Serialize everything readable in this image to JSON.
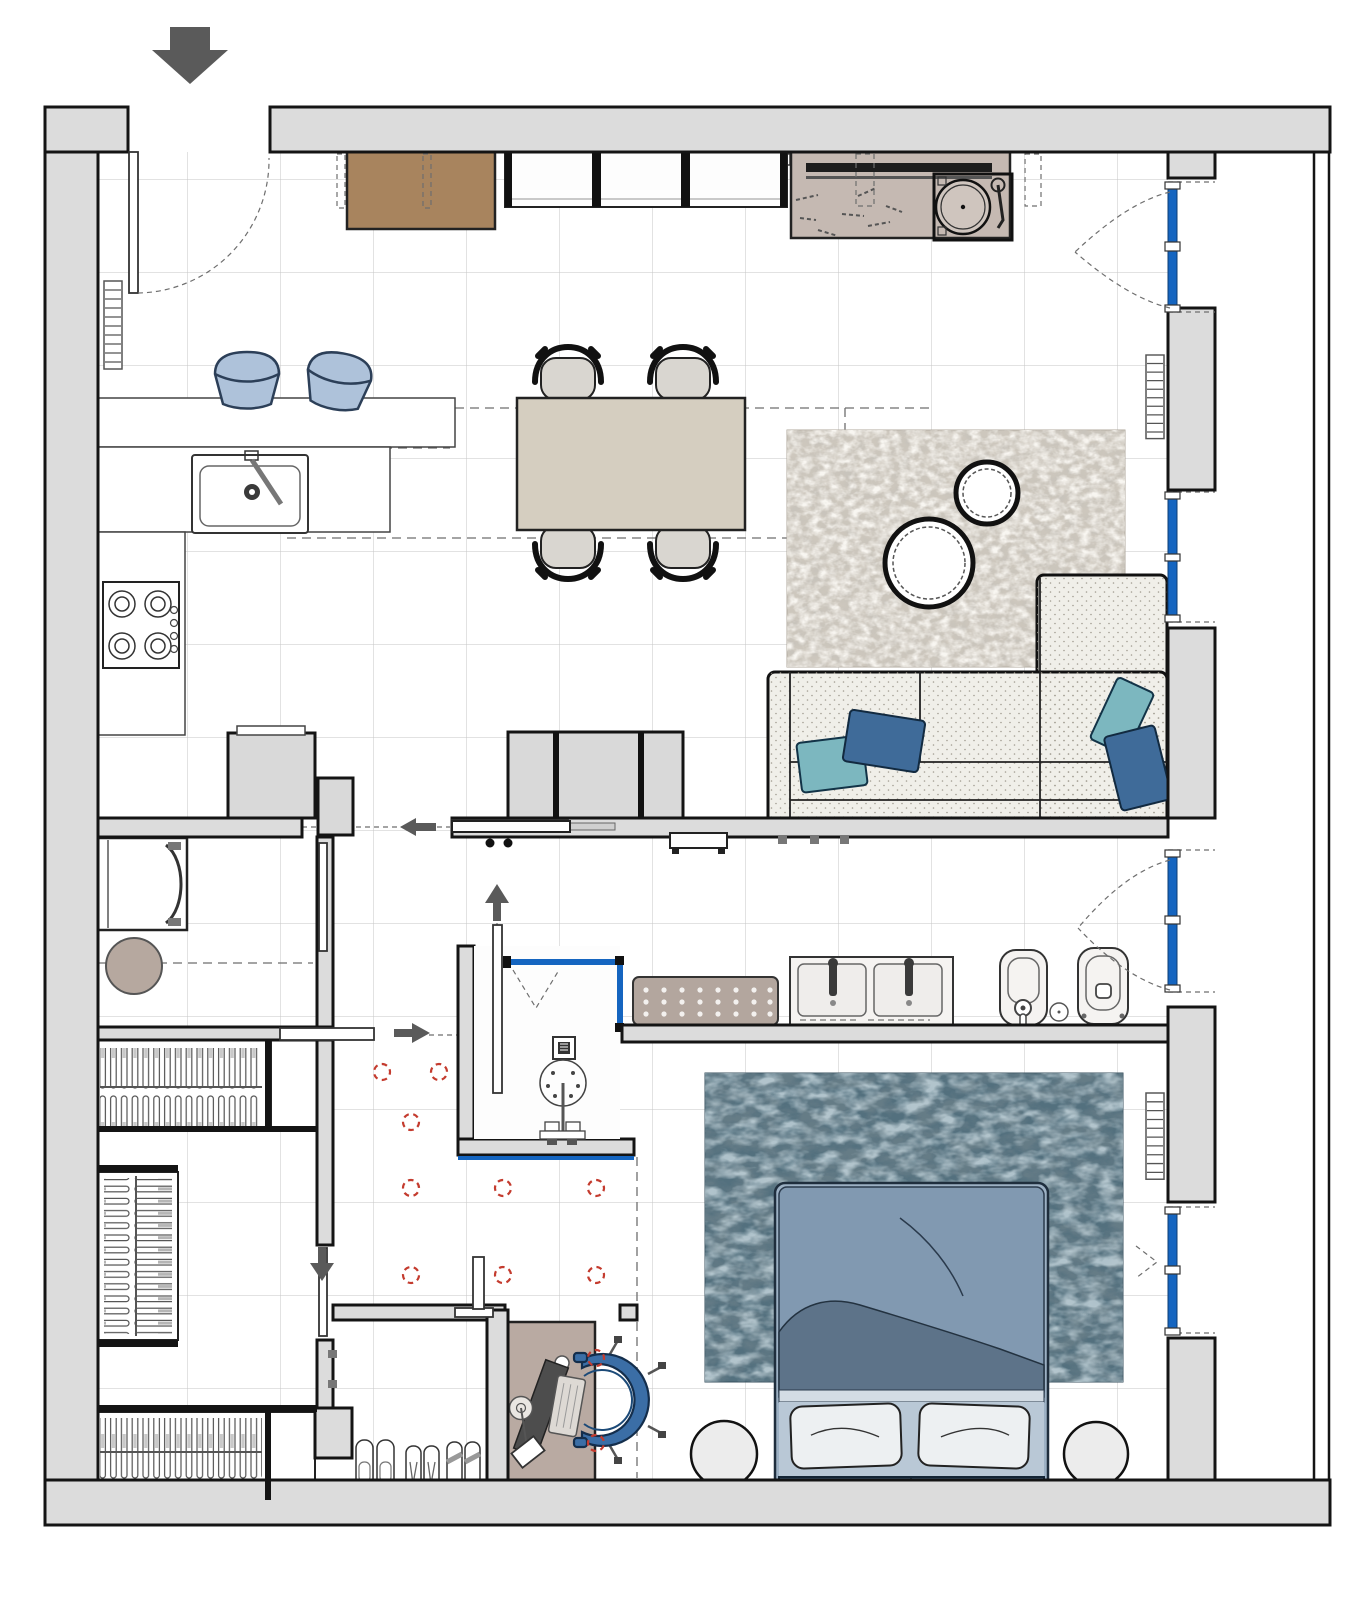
{
  "document": {
    "type": "apartment floor plan",
    "view": "top-down architectural interior drawing",
    "visible_text": "none"
  },
  "palette": {
    "wall_fill": "#dcdcdc",
    "wall_line": "#141414",
    "grid_line": "#c6c6c6",
    "dash_line": "#6e6e6e",
    "glass_blue": "#1565c0",
    "arrow_gray": "#5a5a5a",
    "accent_red": "#c43b2e",
    "wood_brown": "#a8845e",
    "sideboard_mauve": "#c5b9b2",
    "table_beige": "#d5cec0",
    "seat_gray": "#d9d6d0",
    "stool_blue": "#aec2da",
    "stool_line": "#2c3f58",
    "unit_gray": "#d9d9d9",
    "rug_living": "#cdc7bd",
    "sofa_cream": "#f0efe9",
    "pillow_teal": "#7cb7bf",
    "pillow_blue": "#3f6b99",
    "bench_taupe": "#b3a69e",
    "fixture_white": "#f5f3f1",
    "fixture_line": "#333333",
    "rug_bedroom": "#53707e",
    "duvet_blue": "#8199b1",
    "throw_blue": "#5d7389",
    "pillow_white": "#edf0f2",
    "headboard_blue": "#3c5a76",
    "side_table_gray": "#ececec",
    "desk_taupe": "#b9aaa2",
    "chair_blue": "#3b6ea6",
    "basket_taupe": "#b6a89f",
    "leaf_white": "#ffffff",
    "radiator_line": "#555555"
  },
  "rooms": [
    {
      "name": "living-dining-kitchen"
    },
    {
      "name": "laundry"
    },
    {
      "name": "walk-in-closet"
    },
    {
      "name": "hallway"
    },
    {
      "name": "bathroom"
    },
    {
      "name": "bedroom"
    },
    {
      "name": "study-nook"
    },
    {
      "name": "balcony-strip"
    }
  ],
  "furniture": {
    "entry_console": "Entry console",
    "upper_cabinets": "Wall cabinet row",
    "media_sideboard": "Media sideboard with turntable",
    "turntable": "Turntable",
    "dining_table": "Dining table",
    "dining_chair": "Dining chair",
    "bar_stool": "Bar stool",
    "kitchen": "Kitchen counter with sink and gas hob",
    "tall_unit": "Tall kitchen unit",
    "living_rug": "Living room rug with round cutout tables",
    "coffee_table": "Round coffee table",
    "sofa": "L-shaped sectional sofa with cushions",
    "tv_unit": "TV storage unit",
    "tv": "Wall-mounted TV",
    "hall_bench": "Hall shelf",
    "washing_machine": "Washing machine",
    "laundry_basket": "Laundry basket",
    "wardrobe": "Wardrobe with hangers",
    "shoe_rack": "Shoe storage",
    "shower": "Walk-in shower with glass screen",
    "bath_bench": "Upholstered bench",
    "vanity": "Double washbasin vanity",
    "bidet": "Bidet",
    "toilet": "Toilet",
    "bed": "Double bed with duvet and pillows",
    "bedroom_rug": "Bedroom rug",
    "bedside_table": "Round bedside table",
    "desk": "Desk with monitor, keyboard and lamp",
    "desk_chair": "Swivel desk chair",
    "radiator": "Radiator",
    "window": "Window with blue frame",
    "entry_door": "Entry door with swing arc",
    "sliding_door": "Sliding pocket door",
    "spotlight": "Ceiling spotlight",
    "flow_arrow": "Circulation arrow",
    "entry_arrow": "Entrance direction arrow"
  },
  "symbol_counts": {
    "windows": 4,
    "radiators": 3,
    "ceiling_spotlights": 11,
    "sliding_doors": 7,
    "flow_arrows": 4,
    "dining_chairs": 4,
    "bar_stools": 2,
    "shoe_pairs": 3
  }
}
